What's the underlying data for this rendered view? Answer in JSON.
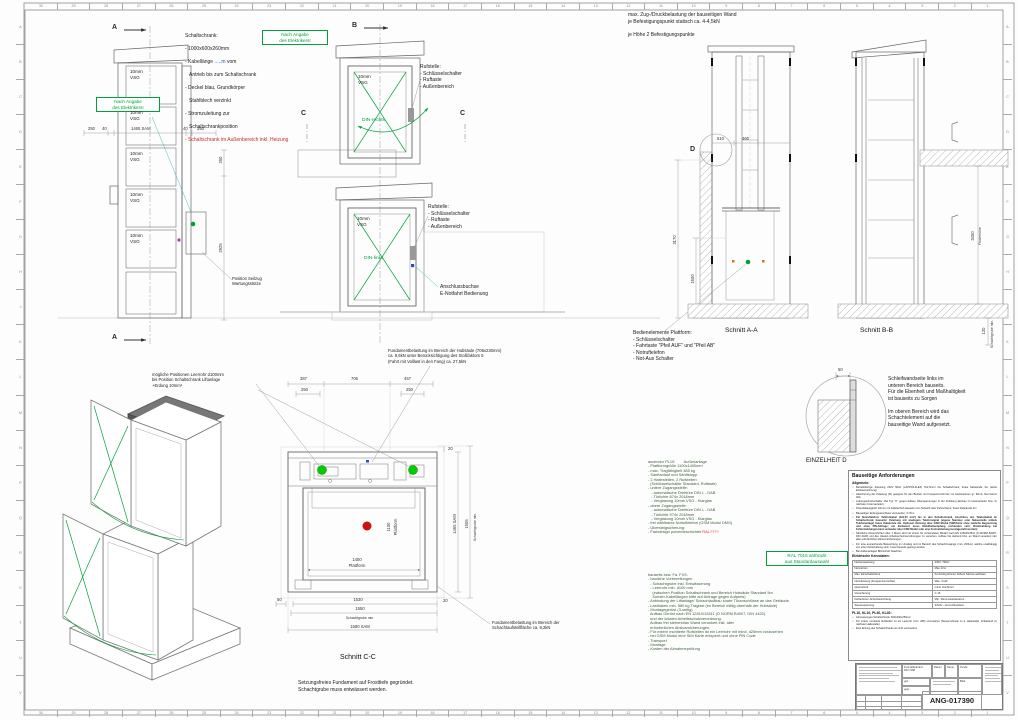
{
  "frame": {
    "columns": [
      "30",
      "29",
      "28",
      "27",
      "26",
      "25",
      "24",
      "23",
      "22",
      "21",
      "20",
      "19",
      "18",
      "17",
      "16",
      "15",
      "14",
      "13",
      "12",
      "11",
      "10",
      "9",
      "8",
      "7",
      "6",
      "5",
      "4",
      "3",
      "2",
      "1"
    ],
    "rows": [
      "A",
      "B",
      "C",
      "D",
      "E",
      "F",
      "G",
      "H",
      "J",
      "K",
      "L",
      "M",
      "N",
      "P",
      "Q",
      "R",
      "S",
      "T",
      "U",
      "V"
    ]
  },
  "markers": {
    "a": "A",
    "b": "B",
    "c": "C",
    "d": "D"
  },
  "glass_label": "10mm\nVSG",
  "din_rechts": "DIN-rechts",
  "din_links": "DIN-links",
  "badges": {
    "elektriker": "Nach Angabe\ndes Elektrikers!",
    "ral": "RAL 7016 anthrazit\naus Standardauswahl"
  },
  "notes": {
    "schaltschrank_title": "Schaltschrank:",
    "schaltschrank_l1": "- 1000x600x260mm",
    "kabel_pre": "- Kabellänge ",
    "kabel_blue": ".....m",
    "kabel_post": " vom",
    "schaltschrank_l3": "Antrieb bis zum Schaltschrank",
    "schaltschrank_l4": "- Deckel blau, Grundkörper",
    "schaltschrank_l5": "Stahlblech verzinkt",
    "schaltschrank_l6": "- Stromzuleitung zur",
    "schaltschrank_l7": "Schaltschrankposition",
    "schaltschrank_red": "- Schaltschrank im Außenbereich inkl. Heizung",
    "rufstelle": "Rufstelle:\n- Schlüsselschalter\n- Ruftaste\n- Außenbereich",
    "anschlussbuchse": "Anschlussbuchse\nE-Notfahrt Bedienung",
    "wand": "max. Zug-/Druckbelastung der bauseitigen Wand\nje Befestigungspunkt statisch ca. 4-4,5kN\n\nje Höhe 2 Befestigungspunkte",
    "bedienelemente": "Bedienelemente Plattform:\n- Schlüsselschalter\n- Fahrtaste \"Pfeil AUF\" und \"Pfeil AB\"\n- Notruftelefon\n- Not-Aus Schalter",
    "einzelheit": "Schleifwandseite links im\nunteren Bereich bauseits.\nFür die Ebenheit und Maßhaltigkeit\nist bauseits zu Sorgen\n\nIm oberen Bereich wird das\nSchachtelement auf die\nbauseitige Wand aufgesetzt.",
    "fundament_hub": "Fundamentbelastung im Bereich der Hubsäule (706x230mm)\nca. 9,6kN unter Berücksichtigung des Stoßfaktors 5\n(Fahrt mit Volllast in den Fang) ca. 27,5kN",
    "leerrohr": "mögliche Positionen Leerrohr d100mm\nbis Position Schaltschrank Liftanlage\n+Erdung 10mm²",
    "fundament_schacht": "Fundamentbelastung im Bereich der\nSchachtaufstellfläche ca. 9,2kN",
    "setzung": "Setzungsfreies Fundament auf Frosttiefe gegründet.\nSchachtgrube muss entwässert werden.",
    "seilzug": "Position Seilzug\nWartungsstütze"
  },
  "section_labels": {
    "aa": "Schnitt A-A",
    "bb": "Schnitt B-B",
    "cc": "Schnitt C-C",
    "detail_d": "EINZELHEIT D"
  },
  "dims": {
    "f250l": "250",
    "f40l": "40",
    "f1465": "1465  SAM",
    "f40r": "40",
    "f250r": "250",
    "f250v": "250",
    "f2925": "2925",
    "a510": "510",
    "a460": "460",
    "a3170": "3170",
    "a1600": "1600",
    "b3450": "3450",
    "b_foerder": "Förderhöhe",
    "b120": "120",
    "b_grube": "Schachtgrube min.",
    "d50": "50",
    "p387": "387",
    "p706": "706",
    "p457": "457",
    "p250a": "250",
    "p250b": "250",
    "p20a": "20",
    "p20b": "20",
    "p1400": "1400",
    "p_plattform_h": "Plattform",
    "p1100": "1100",
    "p_plattform_v": "Plattform",
    "p50": "50",
    "p1530": "1530",
    "p1550": "1550",
    "p_grube_b": "Schachtgrube min.",
    "p1580": "1580  SAM",
    "p1465": "1465  SAM",
    "p1505": "1505",
    "p_grube_r": "Schachtgrube min."
  },
  "spec": {
    "lines": [
      "ascendor PL10:        Außenanlage",
      "- Plattformgröße 1100x1400mm",
      "- max. Tragfähigkeit 385 kg",
      "- Sanftanlauf und Sanftstopp",
      "- 2 Haltestellen, 2 Rufstellen",
      "  (Schlüsselschalter Standard, Ruftaste)",
      "- untere Zugangsstelle:",
      "   - automatische Drehtüre DIN L - DAB",
      "   - Türlichte 874x 2018mm",
      "   - Verglasung 10mm VSG - Klarglas",
      "- obere Zugangsstelle:",
      "   - automatische Drehtüre DIN L - DAB",
      "   - Türlichte 974x 2018mm",
      "   - Verglasung 10mm VSG - Klarglas",
      "- frei wählbares Notruftelefon (GSM Modul DMG)",
      "- Übersteigsicherung:"
    ],
    "last_pre": "- Farbdesign pulverbeschichtet ",
    "last_red": "RAL????"
  },
  "bauseits": {
    "lines": [
      "bauseits bzw. Fa. FXS:",
      "- bauliche Vorbereitungen",
      "  - Schachtgrube inkl. Entwässerung",
      "  - Leerrohr min. d100 mm",
      "    (zwischen Position Schaltschrank und Bereich Hubsäule Standard 5m",
      "    Sonder-Kabellängen bitte auf Anfrage gegen Aufpreis)",
      "- Anbindung der Liftanlage/ Schachtaufbau sowie Türanschlüsse an das Gebäude.",
      "- Lasthaken min. 580 kg Traglast (im Bereich mittig oberhalb der Hubsäule)",
      "- Montagegerüst (3-seitig)",
      "  Aufbau Gerüst nach EN 12810/12811 (Ö NORM B4007, DIN 4420)",
      "  und der lokalen Arbeitsschutzverordnung.",
      "  Aufbau frei stehend/an Wand verankert inkl. aller",
      "  erforderlichen Absturzsicherungen.",
      "- Für extern montierte Rufstellen ist ein Leerrohr mit mind. d25mm vorzusehen",
      "- bei GSM Modul eine SIM Karte entsperrt und ohne PIN Code",
      "- Transport",
      "- Montage",
      "- Kosten der Abnahmeprüfung"
    ]
  },
  "panel": {
    "title": "Bauseitige Anforderungen",
    "allgemein_label": "Allgemein:",
    "bullets": [
      "Betriebsfertige Zuleitung 230V 50Hz (LAPP/ÖLFLEX) 5x2,5mm² bis Schaltschrank, freies Kabelende 3m (siehe Einbauzeichnung)",
      "Absicherung der Zuleitung (FI) geeignet für den Betrieb mit Frequenzumformer mit Auslösestrom gr. 30mA, Nennstrom 40A",
      "Leitungsschutzschalter 16A Typ \"C\" gegen äußere Überspannungen in der Zuleitung (Einbau im Hausverteiler bzw. im nächsten Unterverteiler)",
      "Potentialausgleich 10mm² mit Kabelschuh bauseits zum Schacht oder Fahrschiene, freies Kabelende 3m",
      "Bauseitiger Erdungsanschluss vorzusehen, 0 Ohm",
      "Für Notruftelefon: Telefonkabel (4x0,25 mm²) bis in den Schaltschrank, Anschluss des Telefonkabel im Schaltschrank bauseits! Zuleitung mit analogem Telefonsignal (eigene Nummer oder Nebenstelle mittels Telefonanlage) freies Kabelende 3m. Optional: Nutzung über GSM Modul (SIM-Karte ohne zeitliche Begrenzung und ohne PIN-Abfrage; am Einbauort muss Mobilfunkempfang vorhanden sein; Rückmeldung bei Fehlermeldungen kann entweder über GSM Modul oder eine Festnetzleitung bereitgestellt werden)",
      "Sämtliche Absturzhöhen über 1 Meter sind mit einem für verwendeten Bedarf nach EN 12810/12811 (Ö-NORM B4007, DIN 4420) und den lokalen Arbeitsschutzverordnungen zu versehen. Aufbau frei stehend bzw. an Wand verankert inkl. aller erforderlichen Absturzsicherungen.",
      "Für eine ausreichende Beleuchtung im Umstieg und im Bereich des Schachtzugangs (min. 200lux), welche unabhängig von einer Zeitschaltung sind, muss bauseits gesorgt werden",
      "Bei Außenanlagen Blitzschutz beachten"
    ],
    "kenndaten_label": "Elektrische Kenndaten:",
    "table": [
      [
        "Netzeinspeisung",
        "230V / 50Hz"
      ],
      [
        "Nennstrom",
        "Max 13 A"
      ],
      [
        "Max. Einschaltströme",
        "Kurzzeitig können höhere Ströme auftreten"
      ],
      [
        "Nennleistung (Frequenzumrichter)",
        "Max. 3 kW"
      ],
      [
        "Querschnitt",
        "mind. 3x2,5mm²"
      ],
      [
        "Vorsicherung",
        "C 16"
      ],
      [
        "Fehlerstrom-Schutzeinrichtung",
        "Min. 30mA Auslösestrom"
      ],
      [
        "Steuerspannung",
        "24Vdc – kurzschlussfest"
      ]
    ],
    "footer_title": "PL10, KL10, PL40, KL40:",
    "footer_bullets": [
      "Abmessungen Schaltschrank: 600x400x250mm",
      "Für extern montierte Rufstellen ist ein Leerrohr (min. d25) vorzusehen (Steuerschrank zu 1. Haltestelle, fortlaufend zu nächster Haltestelle)",
      "Eine Erdung des Schaltschranks ist nicht vorzusehen"
    ]
  },
  "title_block": {
    "number": "ANG-017390",
    "tol": "Freimaßtoleranz\nDIN 7168",
    "datum": "Datum",
    "name": "Name",
    "gez": "gez.",
    "gepr": "gepr.",
    "kunde": "Kunde",
    "blatt": "Blatt"
  }
}
